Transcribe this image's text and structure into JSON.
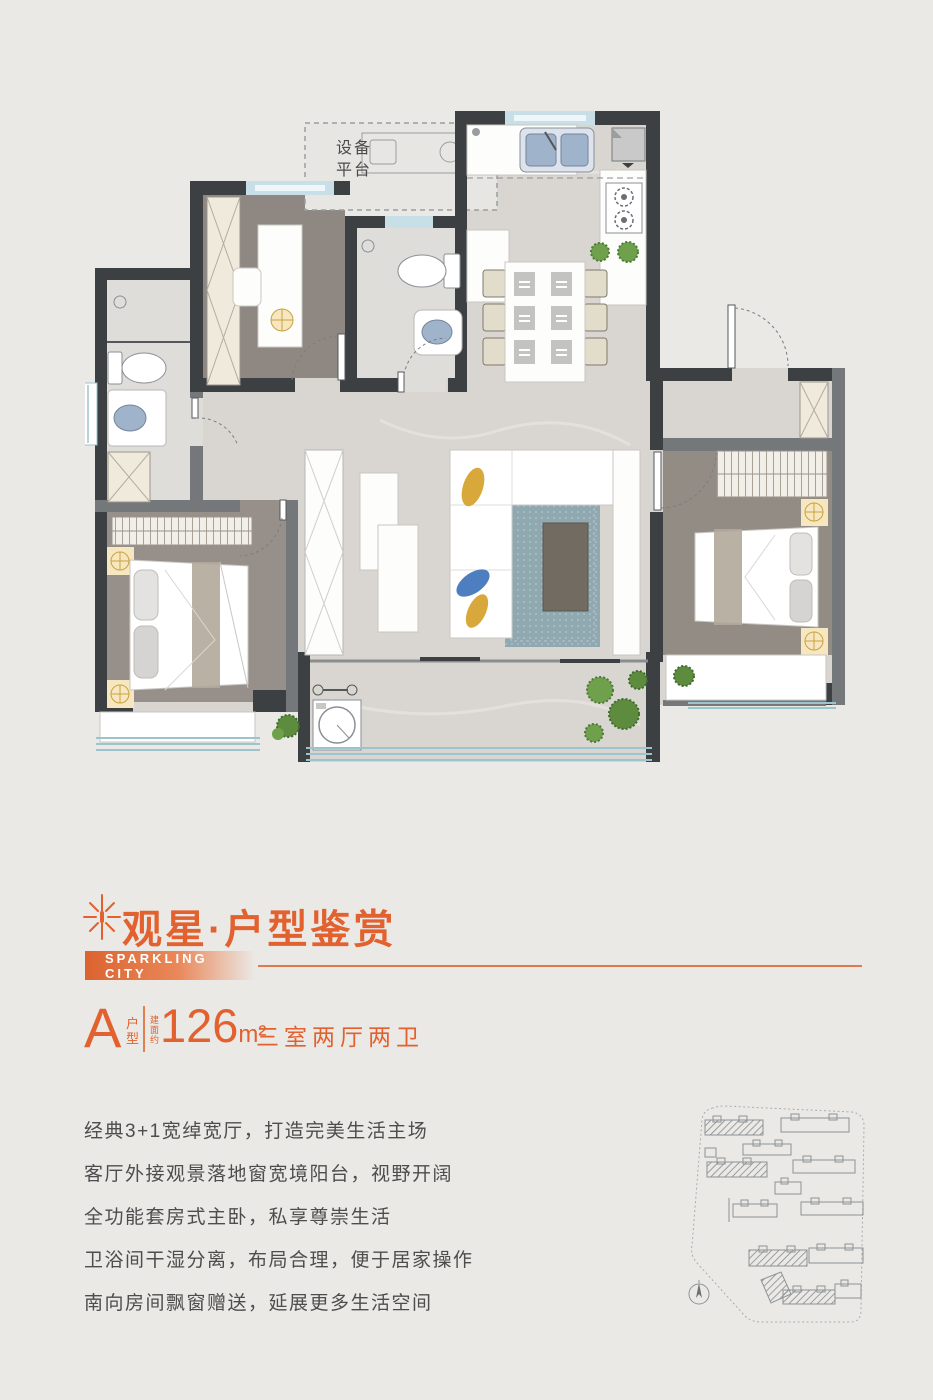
{
  "colors": {
    "accent": "#E2612F",
    "rule_line": "#DE7B4B",
    "wall_dark": "#3C4043",
    "wall_gray": "#75787B",
    "window_blue": "#C8DFE8",
    "body_text": "#4D4D4D"
  },
  "floorplan": {
    "platform_line1": "设备",
    "platform_line2": "平台"
  },
  "header": {
    "title": "观星·户型鉴赏",
    "subtitle": "SPARKLING CITY"
  },
  "unit": {
    "letter": "A",
    "letter_caption": "户型",
    "area_prefix": "建面约",
    "area_number": "126",
    "area_unit": "m²",
    "rooms": "三室两厅两卫"
  },
  "features": [
    "经典3+1宽绰宽厅，打造完美生活主场",
    "客厅外接观景落地窗宽境阳台，视野开阔",
    "全功能套房式主卧，私享尊崇生活",
    "卫浴间干湿分离，布局合理，便于居家操作",
    "南向房间飘窗赠送，延展更多生活空间"
  ]
}
